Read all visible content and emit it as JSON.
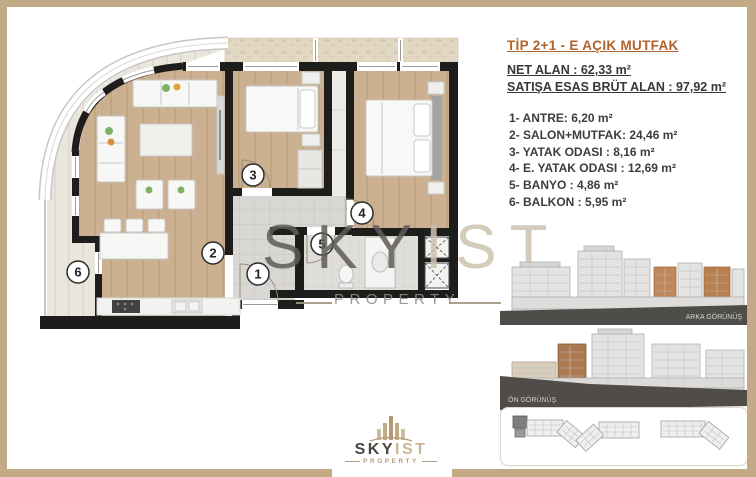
{
  "header": {
    "title": "TİP 2+1 - E AÇIK MUTFAK",
    "net_line": "NET ALAN : 62,33 m²",
    "gross_line": "SATIŞA ESAS BRÜT ALAN : 97,92 m²"
  },
  "room_list": [
    {
      "text": "1- ANTRE: 6,20 m²"
    },
    {
      "text": "2- SALON+MUTFAK: 24,46 m²"
    },
    {
      "text": "3- YATAK ODASI : 8,16 m²"
    },
    {
      "text": "4- E. YATAK ODASI : 12,69 m²"
    },
    {
      "text": "5- BANYO : 4,86 m²"
    },
    {
      "text": "6- BALKON : 5,95 m²"
    }
  ],
  "plan": {
    "numbers": {
      "n1": "1",
      "n2": "2",
      "n3": "3",
      "n4": "4",
      "n5": "5",
      "n6": "6"
    }
  },
  "elevations": {
    "back_label": "ARKA GÖRÜNÜŞ",
    "front_label": "ÖN GÖRÜNÜŞ"
  },
  "watermark": {
    "sky": "SKY",
    "ist": "IST",
    "property": "PROPERTY"
  },
  "logo": {
    "sky": "SKY",
    "ist": "IST",
    "property": "PROPERTY"
  },
  "colors": {
    "frame": "#c3aa87",
    "accent_title": "#b2612c",
    "wall": "#1d1d1b",
    "wood_floor": "#cbb092",
    "tile_floor": "#d8d7d4",
    "balcony_floor": "#eae6dd",
    "elevation_orange": "#c08657",
    "ground_dark": "#4f4d4a"
  }
}
